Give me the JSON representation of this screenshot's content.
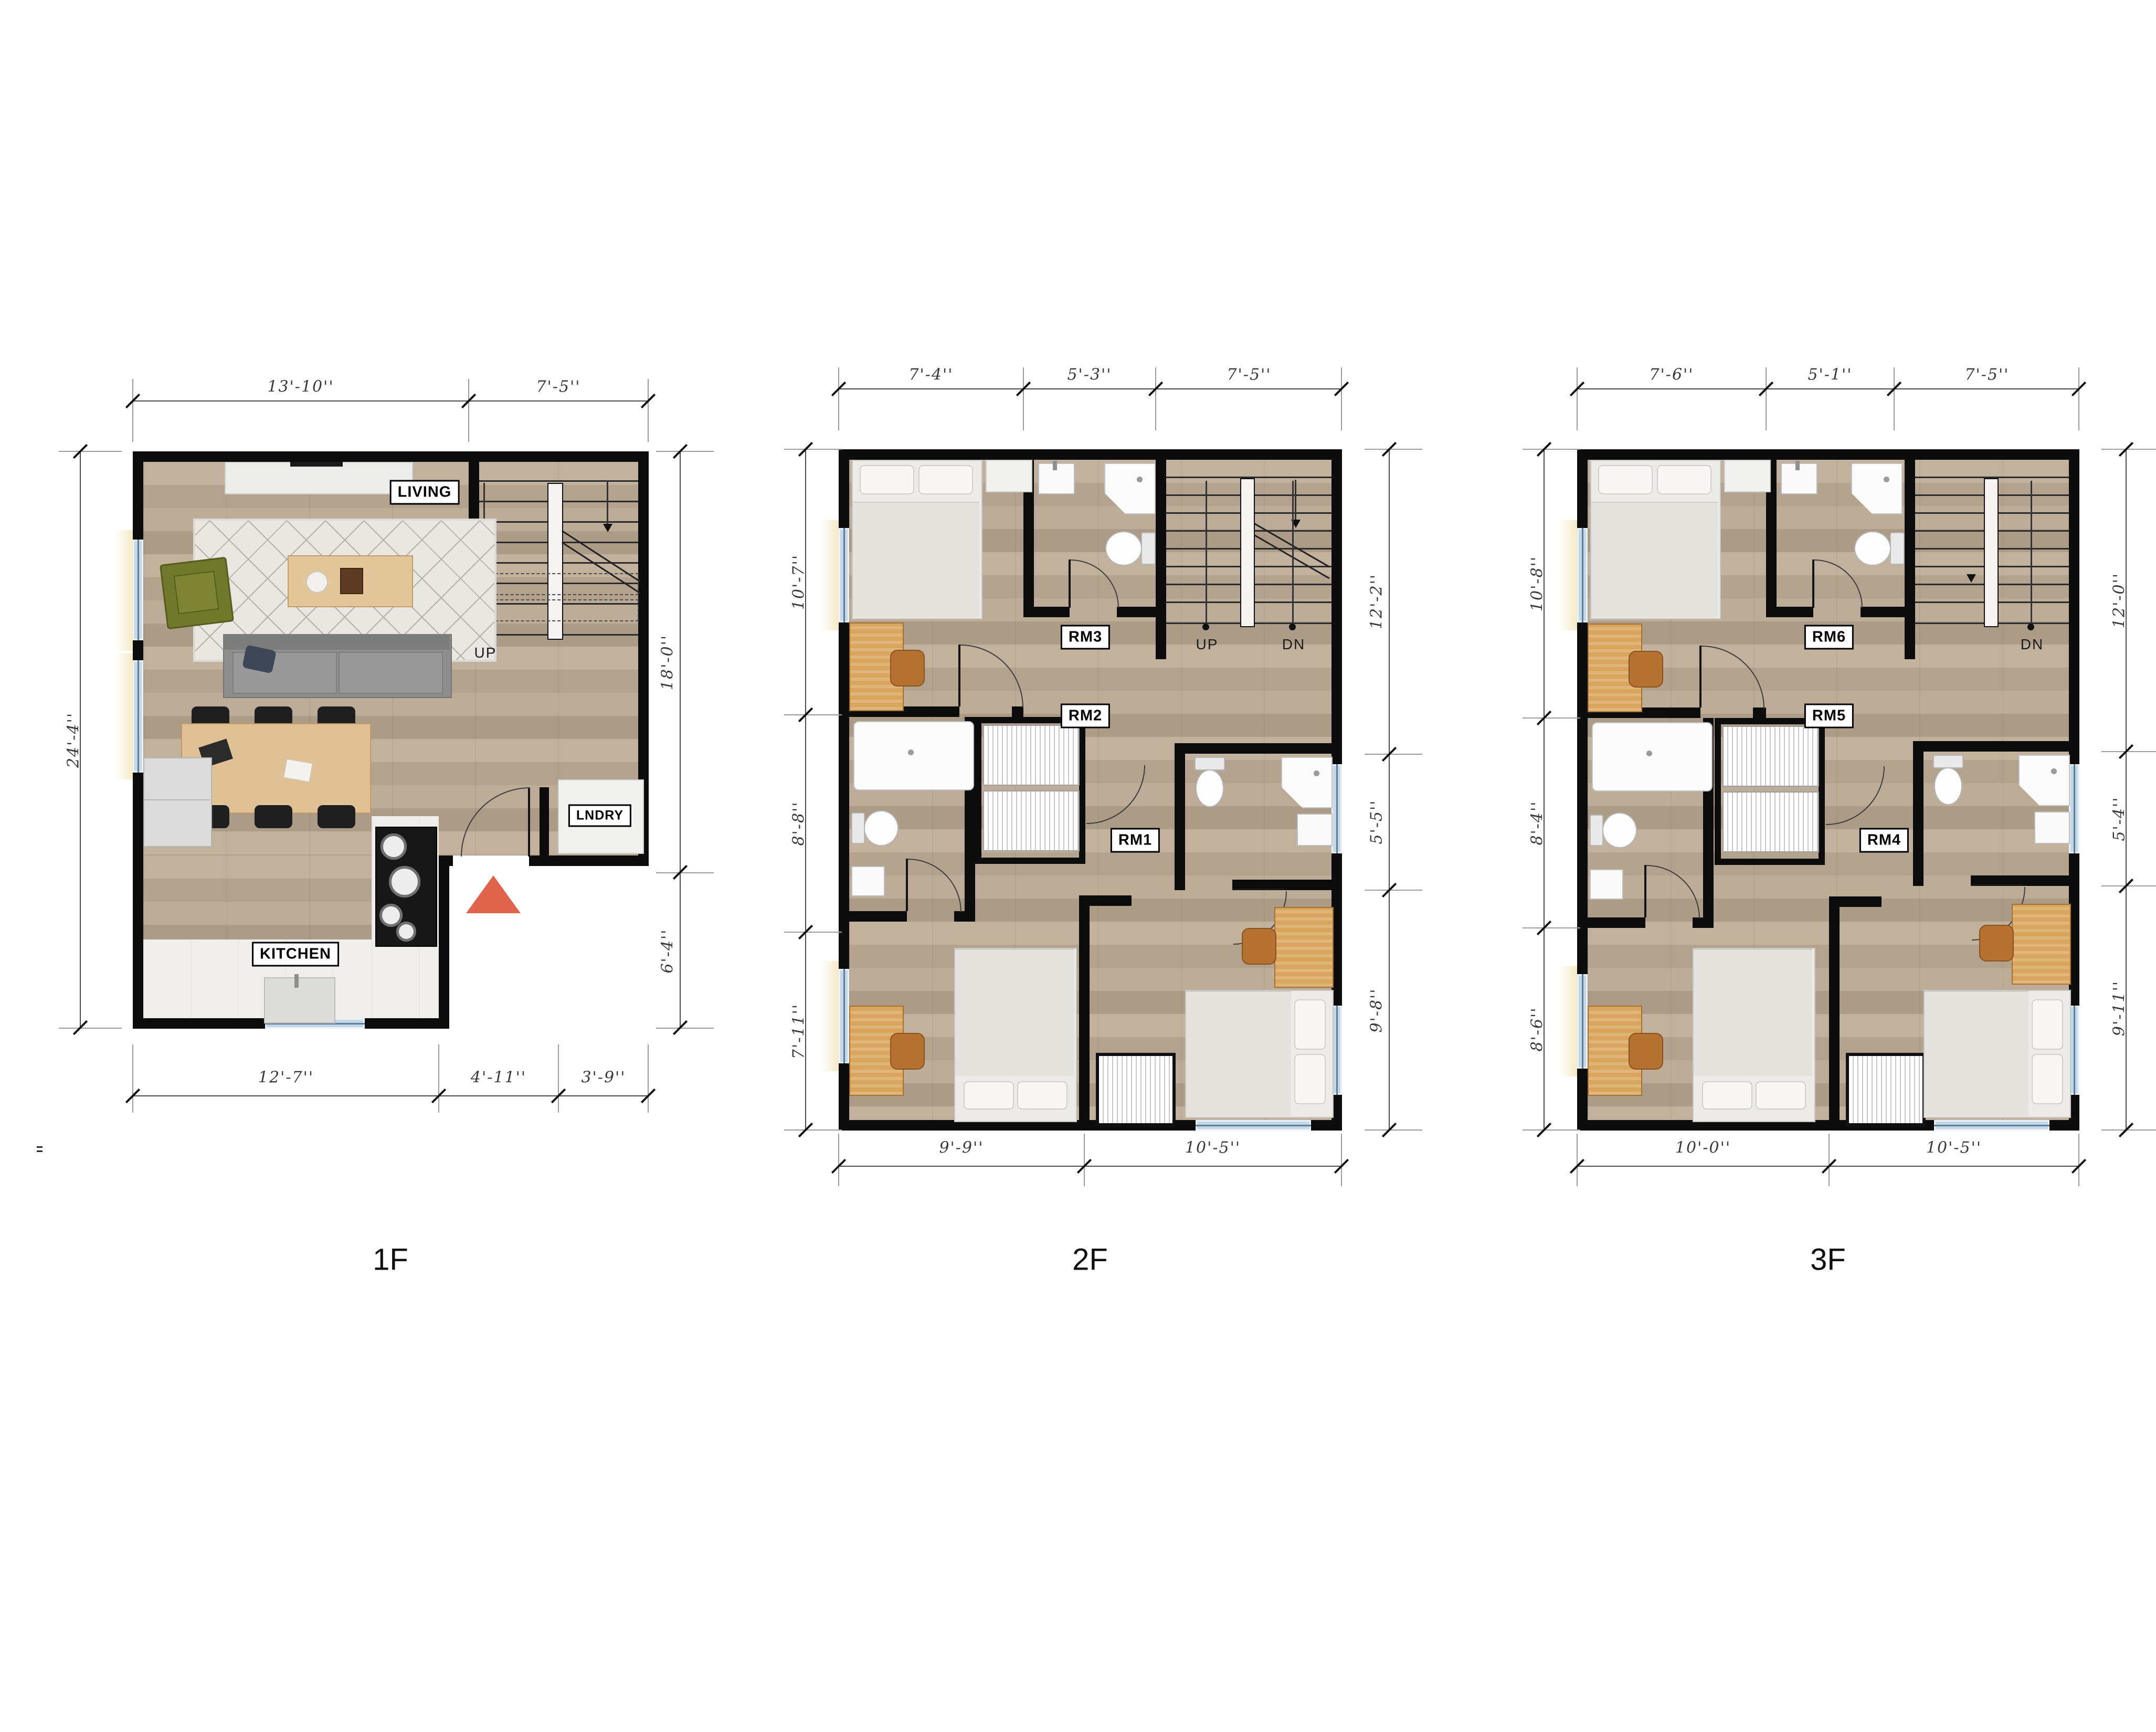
{
  "colors": {
    "wall": "#0c0c0c",
    "wood_floor": "#b6a48f",
    "window_glass": "#c3d7e7",
    "entry_marker_red": "#e0644b",
    "dim_text": "#3a3a3a",
    "label_bg": "#ffffff",
    "label_border": "#000000"
  },
  "stray_mark": "=",
  "floors": {
    "f1": {
      "title": "1F",
      "dims": {
        "top": [
          "13'-10''",
          "7'-5''"
        ],
        "left": [
          "24'-4''"
        ],
        "right": [
          "18'-0''",
          "6'-4''"
        ],
        "bottom": [
          "12'-7''",
          "4'-11''",
          "3'-9''"
        ]
      },
      "rooms": {
        "living": "LIVING",
        "kitchen": "KITCHEN",
        "laundry": "LNDRY"
      },
      "stairs": {
        "up": "UP"
      }
    },
    "f2": {
      "title": "2F",
      "dims": {
        "top": [
          "7'-4''",
          "5'-3''",
          "7'-5''"
        ],
        "left": [
          "10'-7''",
          "8'-8''",
          "7'-11''"
        ],
        "right": [
          "12'-2''",
          "5'-5''",
          "9'-8''"
        ],
        "bottom": [
          "9'-9''",
          "10'-5''"
        ]
      },
      "rooms": {
        "rm3": "RM3",
        "rm2": "RM2",
        "rm1": "RM1"
      },
      "stairs": {
        "up": "UP",
        "dn": "DN"
      }
    },
    "f3": {
      "title": "3F",
      "dims": {
        "top": [
          "7'-6''",
          "5'-1''",
          "7'-5''"
        ],
        "left": [
          "10'-8''",
          "8'-4''",
          "8'-6''"
        ],
        "right": [
          "12'-0''",
          "5'-4''",
          "9'-11''"
        ],
        "bottom": [
          "10'-0''",
          "10'-5''"
        ]
      },
      "rooms": {
        "rm6": "RM6",
        "rm5": "RM5",
        "rm4": "RM4"
      },
      "stairs": {
        "dn": "DN"
      }
    }
  }
}
